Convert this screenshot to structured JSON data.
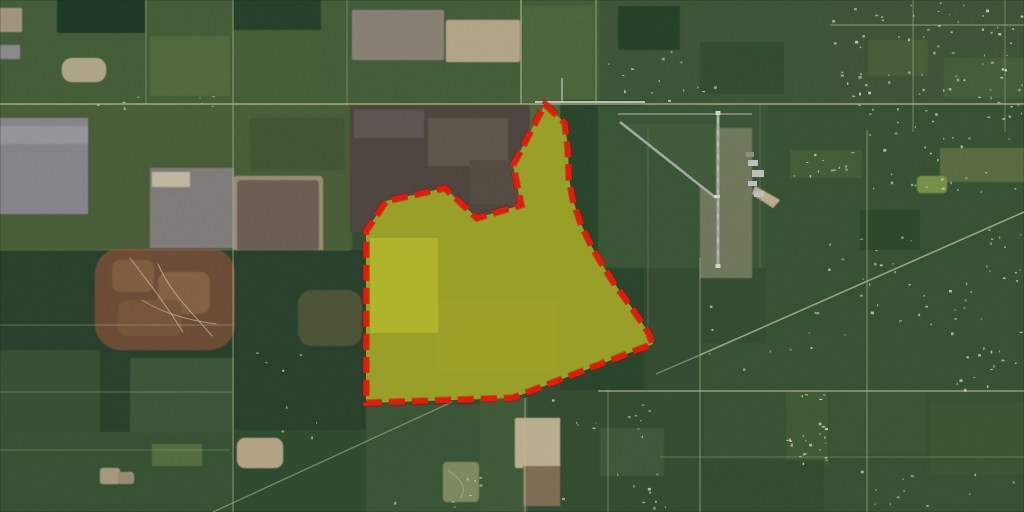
{
  "map": {
    "width": 1024,
    "height": 512,
    "base_color": "#3a5537",
    "fields": [
      [
        0,
        0,
        600,
        105,
        "#4e6841",
        1,
        0
      ],
      [
        600,
        0,
        424,
        108,
        "#44613c",
        1,
        0
      ],
      [
        57,
        0,
        88,
        33,
        "#24402a",
        1,
        0
      ],
      [
        233,
        0,
        88,
        30,
        "#2b4930",
        1,
        0
      ],
      [
        150,
        36,
        80,
        60,
        "#5b7544",
        1,
        0
      ],
      [
        235,
        32,
        85,
        70,
        "#4f6a3e",
        1,
        0
      ],
      [
        0,
        8,
        22,
        24,
        "#b3a68b",
        1,
        0
      ],
      [
        0,
        45,
        20,
        14,
        "#9a989b",
        1,
        0
      ],
      [
        62,
        58,
        44,
        24,
        "#c3b999",
        1,
        10
      ],
      [
        352,
        10,
        92,
        50,
        "#988f82",
        1,
        2
      ],
      [
        446,
        20,
        74,
        42,
        "#c6b897",
        1,
        2
      ],
      [
        522,
        6,
        72,
        96,
        "#567243",
        1,
        0
      ],
      [
        618,
        6,
        62,
        44,
        "#2b4a2e",
        1,
        0
      ],
      [
        700,
        42,
        84,
        52,
        "#385736",
        1,
        0
      ],
      [
        830,
        0,
        194,
        132,
        "#465f3d",
        1,
        0
      ],
      [
        868,
        40,
        60,
        36,
        "#51683f",
        1,
        0
      ],
      [
        944,
        58,
        80,
        40,
        "#4e6a40",
        1,
        0
      ],
      [
        0,
        105,
        352,
        147,
        "#52683f",
        1,
        0
      ],
      [
        0,
        118,
        88,
        96,
        "#95949b",
        1,
        0
      ],
      [
        0,
        126,
        88,
        18,
        "#a7a6ad",
        1,
        0
      ],
      [
        150,
        168,
        84,
        80,
        "#8c8b87",
        1,
        0
      ],
      [
        233,
        176,
        90,
        79,
        "#ab9d83",
        1,
        4
      ],
      [
        237,
        180,
        82,
        71,
        "#776a5e",
        1,
        4
      ],
      [
        152,
        172,
        38,
        15,
        "#d5ccb0",
        1,
        0
      ],
      [
        250,
        118,
        95,
        52,
        "#47613b",
        1,
        0
      ],
      [
        350,
        105,
        182,
        127,
        "#544f47",
        1,
        0
      ],
      [
        354,
        110,
        70,
        28,
        "#67615a",
        1,
        0
      ],
      [
        428,
        118,
        80,
        48,
        "#6b6054",
        1,
        0
      ],
      [
        470,
        160,
        52,
        44,
        "#5e564c",
        1,
        0
      ],
      [
        530,
        105,
        34,
        50,
        "#5a7245",
        1,
        0
      ],
      [
        0,
        250,
        366,
        262,
        "#2e4a32",
        1,
        0
      ],
      [
        95,
        248,
        140,
        102,
        "#7a573c",
        1,
        26
      ],
      [
        112,
        260,
        42,
        32,
        "#8f6847",
        1,
        8
      ],
      [
        158,
        272,
        52,
        42,
        "#936c4a",
        1,
        10
      ],
      [
        118,
        300,
        64,
        36,
        "#85603f",
        1,
        10
      ],
      [
        298,
        290,
        64,
        56,
        "#5e6040",
        0.85,
        14
      ],
      [
        0,
        350,
        100,
        85,
        "#3c5a38",
        1,
        0
      ],
      [
        130,
        358,
        104,
        74,
        "#436040",
        1,
        0
      ],
      [
        0,
        432,
        233,
        80,
        "#3d5b39",
        1,
        0
      ],
      [
        233,
        430,
        133,
        82,
        "#365435",
        1,
        0
      ],
      [
        237,
        438,
        46,
        30,
        "#c9b794",
        1,
        8
      ],
      [
        100,
        468,
        20,
        16,
        "#b7a98c",
        1,
        3
      ],
      [
        118,
        472,
        16,
        12,
        "#a99b80",
        1,
        3
      ],
      [
        152,
        444,
        50,
        22,
        "#5d7a47",
        1,
        0
      ],
      [
        366,
        405,
        114,
        107,
        "#41603c",
        1,
        0
      ],
      [
        443,
        462,
        36,
        40,
        "#8c9a6b",
        1,
        4
      ],
      [
        480,
        398,
        48,
        114,
        "#47653f",
        1,
        0
      ],
      [
        515,
        418,
        46,
        50,
        "#cfc2a0",
        1,
        2
      ],
      [
        523,
        466,
        48,
        40,
        "#8d7a5e",
        1,
        2
      ],
      [
        560,
        100,
        84,
        295,
        "#2f5031",
        1,
        0
      ],
      [
        598,
        106,
        168,
        162,
        "#41603c",
        1,
        0
      ],
      [
        700,
        128,
        52,
        150,
        "#7b8765",
        1,
        0
      ],
      [
        766,
        105,
        258,
        238,
        "#3d5b38",
        1,
        0
      ],
      [
        940,
        148,
        84,
        34,
        "#66784a",
        1,
        0
      ],
      [
        917,
        176,
        30,
        17,
        "#85a050",
        1,
        4
      ],
      [
        860,
        210,
        60,
        40,
        "#33522f",
        1,
        0
      ],
      [
        790,
        150,
        72,
        28,
        "#4c6741",
        1,
        0
      ],
      [
        700,
        343,
        324,
        169,
        "#3e5c39",
        1,
        0
      ],
      [
        786,
        391,
        42,
        74,
        "#49653e",
        1,
        0
      ],
      [
        830,
        392,
        96,
        62,
        "#43603b",
        1,
        0
      ],
      [
        930,
        402,
        94,
        72,
        "#406039",
        1,
        0
      ],
      [
        700,
        460,
        124,
        52,
        "#395736",
        1,
        0
      ],
      [
        560,
        390,
        142,
        122,
        "#3a5736",
        1,
        0
      ],
      [
        600,
        428,
        64,
        48,
        "#476340",
        1,
        0
      ]
    ],
    "polygons": [
      [
        "620,124 716,124 716,196",
        "#486540",
        1
      ],
      [
        "755,186 780,200 773,208 752,194",
        "#cfc0a0",
        1
      ]
    ],
    "roads": [
      [
        0,
        104,
        1024,
        104,
        "#ccd0a2",
        1.5,
        0.8
      ],
      [
        535,
        102,
        645,
        102,
        "#e6e3d4",
        2,
        0.9
      ],
      [
        562,
        78,
        562,
        103,
        "#e0ddcd",
        1.5,
        0.8
      ],
      [
        146,
        0,
        146,
        104,
        "#c5cb9d",
        1,
        0.5
      ],
      [
        233,
        0,
        233,
        512,
        "#bcc494",
        1.3,
        0.6
      ],
      [
        347,
        0,
        347,
        106,
        "#b9c391",
        1,
        0.5
      ],
      [
        521,
        0,
        521,
        104,
        "#d6d8b6",
        1.4,
        0.7
      ],
      [
        596,
        0,
        596,
        104,
        "#d2d4b0",
        1.2,
        0.6
      ],
      [
        0,
        250,
        350,
        250,
        "#90a06b",
        1,
        0.4
      ],
      [
        0,
        325,
        233,
        325,
        "#c5cb9d",
        1,
        0.45
      ],
      [
        0,
        392,
        233,
        392,
        "#c2c89a",
        1,
        0.45
      ],
      [
        0,
        450,
        230,
        450,
        "#b9c292",
        1,
        0.4
      ],
      [
        213,
        512,
        452,
        402,
        "#c9cf9f",
        1.3,
        0.55
      ],
      [
        525,
        398,
        525,
        512,
        "#cfd2ab",
        1.2,
        0.6
      ],
      [
        608,
        390,
        608,
        512,
        "#c3cb9a",
        1,
        0.5
      ],
      [
        700,
        258,
        700,
        512,
        "#c3cb9a",
        1.2,
        0.55
      ],
      [
        648,
        128,
        648,
        345,
        "#a8b583",
        1,
        0.35
      ],
      [
        760,
        105,
        760,
        268,
        "#9fb07c",
        1,
        0.3
      ],
      [
        598,
        391,
        1024,
        391,
        "#d2d5ad",
        1.5,
        0.7
      ],
      [
        660,
        457,
        1024,
        457,
        "#bdc596",
        1,
        0.4
      ],
      [
        867,
        130,
        867,
        512,
        "#c3cb9a",
        1.2,
        0.55
      ],
      [
        913,
        0,
        913,
        132,
        "#cdd1a3",
        1,
        0.5
      ],
      [
        1005,
        0,
        1005,
        132,
        "#cdd1a3",
        1,
        0.45
      ],
      [
        830,
        25,
        1024,
        25,
        "#cdd1a3",
        1.2,
        0.55
      ],
      [
        700,
        355,
        1024,
        212,
        "#d8dab4",
        1.6,
        0.7
      ],
      [
        656,
        374,
        700,
        355,
        "#d8dab4",
        1.3,
        0.5
      ]
    ],
    "trails": [
      [
        "M538,152 C533,190 526,225 521,258",
        "#dce489",
        1.2,
        0.8
      ],
      [
        "M470,216 C500,228 516,243 520,266",
        "#dce489",
        1.2,
        0.7
      ],
      [
        "M520,266 C520,300 512,330 516,362",
        "#d6de85",
        1,
        0.6
      ],
      [
        "M520,266 C550,282 588,302 622,330",
        "#d6de85",
        1,
        0.6
      ],
      [
        "M437,220 L437,332",
        "#cdd67e",
        1,
        0.55
      ],
      [
        "M440,330 C468,348 494,356 519,364",
        "#e4e8a6",
        1.2,
        0.7
      ],
      [
        "M130,258 C148,282 163,300 183,332",
        "#e3d9b8",
        1,
        0.7
      ],
      [
        "M158,264 C170,292 188,308 212,336",
        "#e3d9b8",
        1,
        0.7
      ],
      [
        "M142,300 C164,314 188,320 216,324",
        "#e3d9b8",
        1,
        0.6
      ],
      [
        "M448,470 C459,478 468,487 461,497",
        "#cdd39b",
        1,
        0.6
      ],
      [
        "M390,222 C420,216 450,212 470,216",
        "#c9d37c",
        1,
        0.5
      ]
    ],
    "airport": {
      "lines": [
        [
          718,
          112,
          718,
          268,
          "#b6bbb7",
          3,
          1,
          ""
        ],
        [
          620,
          122,
          716,
          198,
          "#b6bbb7",
          2.5,
          1,
          ""
        ],
        [
          618,
          114,
          752,
          114,
          "#a9ae9f",
          1.5,
          0.9,
          ""
        ],
        [
          718,
          118,
          718,
          262,
          "#eff1ea",
          0.7,
          0.9,
          "5 7"
        ]
      ],
      "rects": [
        [
          715.5,
          111,
          5,
          4,
          "#e9ebe5"
        ],
        [
          715.5,
          264,
          5,
          4,
          "#e9ebe5"
        ],
        [
          714,
          195,
          6,
          3,
          "#e9ebe5"
        ],
        [
          748,
          160,
          10,
          6,
          "#d2d4cf"
        ],
        [
          752,
          170,
          12,
          7,
          "#d2d4cf"
        ],
        [
          748,
          181,
          9,
          5,
          "#d2d4cf"
        ],
        [
          754,
          191,
          10,
          6,
          "#d2d4cf"
        ],
        [
          746,
          152,
          8,
          5,
          "#9aa092"
        ]
      ]
    },
    "house_clusters": [
      [
        832,
        2,
        190,
        126,
        85,
        "#e6e2d2"
      ],
      [
        604,
        50,
        120,
        52,
        14,
        "#e6e2d2"
      ],
      [
        790,
        152,
        70,
        26,
        12,
        "#dfdbc8"
      ],
      [
        868,
        132,
        150,
        70,
        25,
        "#dfdbc8"
      ],
      [
        820,
        228,
        200,
        110,
        45,
        "#dfdbc8"
      ],
      [
        786,
        393,
        40,
        70,
        26,
        "#e8e4d4"
      ],
      [
        952,
        347,
        66,
        42,
        14,
        "#e6e2d2"
      ],
      [
        390,
        470,
        300,
        38,
        18,
        "#dcd8c6"
      ],
      [
        60,
        96,
        300,
        12,
        8,
        "#d8d4c0"
      ],
      [
        240,
        352,
        120,
        90,
        8,
        "#cfd3be"
      ],
      [
        545,
        398,
        120,
        40,
        12,
        "#dcd8c6"
      ],
      [
        700,
        300,
        120,
        70,
        10,
        "#d4d0ba"
      ],
      [
        836,
        466,
        180,
        40,
        12,
        "#d4d0ba"
      ]
    ]
  },
  "parcel": {
    "points": "545,104 565,123 568,150 569,178 573,200 581,224 592,247 602,264 612,280 622,294 632,308 641,321 648,332 653,344 513,398 366,403 366,231 386,201 445,188 477,218 521,205 513,165",
    "underlay_fill": "#6e7d44",
    "bright_blocks": [
      [
        370,
        238,
        68,
        95,
        "#9fae47",
        0.75
      ],
      [
        438,
        300,
        120,
        70,
        "#76863f",
        0.5
      ]
    ],
    "fill": "#d9d400",
    "fill_opacity": 0.4,
    "stroke": "#e7190d",
    "stroke_width": 5.5,
    "dash": "16 7",
    "stroke_underlay": "#8e0c04",
    "stroke_underlay_width": 7.5,
    "stroke_underlay_opacity": 0.4
  }
}
